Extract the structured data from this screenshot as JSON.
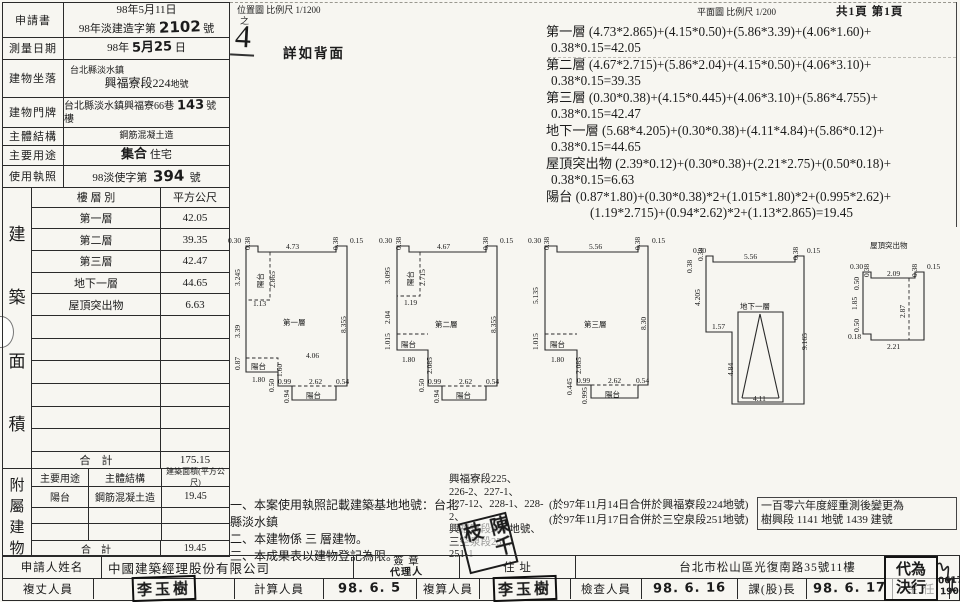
{
  "page": {
    "scale_note_left": "位置圖 比例尺 1/1200",
    "scale_note_left_sub": "之",
    "hand_page_no": "4",
    "detail_note": "詳如背面",
    "scale_note_right": "平面圖 比例尺  1/200",
    "page_count": "共1頁 第1頁"
  },
  "form": {
    "application_label": "申請書",
    "application_line1": "98年5月11日",
    "application_line2_pre": "98年淡建造字第",
    "application_line2_hand": "2102",
    "application_line2_suf": "號",
    "survey_label": "測量日期",
    "survey_pre": "98年",
    "survey_hand": "5月25",
    "survey_suf": "日",
    "location_label": "建物坐落",
    "location_line1": "台北縣淡水鎮",
    "location_line2": "興福寮段224",
    "location_line2_suf": "地號",
    "address_label": "建物門牌",
    "address_pre": "台北縣淡水鎮興福寮66巷",
    "address_hand": "143",
    "address_suf": "號　樓",
    "structure_label": "主體結構",
    "structure_value": "鋼筋混凝土造",
    "use_label": "主要用途",
    "use_hand": "集合",
    "use_value": "住宅",
    "license_label": "使用執照",
    "license_pre": "98淡使字第",
    "license_hand": "394",
    "license_suf": "號"
  },
  "area_table": {
    "section_chars": [
      "建",
      "築",
      "面",
      "積"
    ],
    "col_floor": "樓 層 別",
    "col_area": "平方公尺",
    "rows": [
      [
        "第一層",
        "42.05"
      ],
      [
        "第二層",
        "39.35"
      ],
      [
        "第三層",
        "42.47"
      ],
      [
        "地下一層",
        "44.65"
      ],
      [
        "屋頂突出物",
        "6.63"
      ]
    ],
    "total_label": "合　計",
    "total": "175.15"
  },
  "annex_table": {
    "section_chars": [
      "附",
      "屬",
      "建",
      "物"
    ],
    "col_use": "主要用途",
    "col_structure": "主體結構",
    "col_area": "建築面積(平方公尺)",
    "rows": [
      [
        "陽台",
        "鋼筋混凝土造",
        "19.45"
      ]
    ],
    "total_label": "合　計",
    "total": "19.45"
  },
  "formulas": [
    {
      "line1": "第一層 (4.73*2.865)+(4.15*0.50)+(5.86*3.39)+(4.06*1.60)+",
      "line2": "0.38*0.15=42.05"
    },
    {
      "line1": "第二層 (4.67*2.715)+(5.86*2.04)+(4.15*0.50)+(4.06*3.10)+",
      "line2": "0.38*0.15=39.35"
    },
    {
      "line1": "第三層 (0.30*0.38)+(4.15*0.445)+(4.06*3.10)+(5.86*4.755)+",
      "line2": "0.38*0.15=42.47"
    },
    {
      "line1": "地下一層 (5.68*4.205)+(0.30*0.38)+(4.11*4.84)+(5.86*0.12)+",
      "line2": "0.38*0.15=44.65"
    },
    {
      "line1": "屋頂突出物 (2.39*0.12)+(0.30*0.38)+(2.21*2.75)+(0.50*0.18)+",
      "line2": "0.38*0.15=6.63"
    },
    {
      "line1": "陽台 (0.87*1.80)+(0.30*0.38)*2+(1.015*1.80)*2+(0.995*2.62)+",
      "line2": "(1.19*2.715)+(0.94*2.62)*2+(1.13*2.865)=19.45"
    }
  ],
  "plans": [
    {
      "name": "第一層",
      "labels": [
        {
          "t": "0.30",
          "x": 2,
          "y": 17
        },
        {
          "t": "0.38",
          "x": 24,
          "y": 24,
          "r": 1
        },
        {
          "t": "4.73",
          "x": 60,
          "y": 23
        },
        {
          "t": "0.38",
          "x": 112,
          "y": 24,
          "r": 1
        },
        {
          "t": "0.15",
          "x": 124,
          "y": 17
        },
        {
          "t": "3.245",
          "x": 14,
          "y": 60,
          "r": 1
        },
        {
          "t": "陽台",
          "x": 37,
          "y": 62,
          "r": 1,
          "s": 9
        },
        {
          "t": "2.865",
          "x": 49,
          "y": 62,
          "r": 1
        },
        {
          "t": "1.13",
          "x": 27,
          "y": 80
        },
        {
          "t": "3.39",
          "x": 14,
          "y": 112,
          "r": 1
        },
        {
          "t": "第一層",
          "x": 57,
          "y": 99,
          "s": 11
        },
        {
          "t": "8.355",
          "x": 120,
          "y": 107,
          "r": 1
        },
        {
          "t": "4.06",
          "x": 80,
          "y": 132,
          "s": 10
        },
        {
          "t": "0.87",
          "x": 14,
          "y": 144,
          "r": 1
        },
        {
          "t": "陽台",
          "x": 25,
          "y": 143,
          "s": 9
        },
        {
          "t": "1.80",
          "x": 26,
          "y": 156
        },
        {
          "t": "1.60",
          "x": 56,
          "y": 151,
          "r": 1
        },
        {
          "t": "0.50",
          "x": 48,
          "y": 166,
          "r": 1
        },
        {
          "t": "0.99",
          "x": 52,
          "y": 158
        },
        {
          "t": "2.62",
          "x": 83,
          "y": 158
        },
        {
          "t": "0.54",
          "x": 110,
          "y": 158
        },
        {
          "t": "0.94",
          "x": 63,
          "y": 177,
          "r": 1
        },
        {
          "t": "陽台",
          "x": 80,
          "y": 172,
          "s": 9
        }
      ]
    },
    {
      "name": "第二層",
      "labels": [
        {
          "t": "0.30",
          "x": 2,
          "y": 17
        },
        {
          "t": "0.38",
          "x": 24,
          "y": 24,
          "r": 1
        },
        {
          "t": "4.67",
          "x": 60,
          "y": 23
        },
        {
          "t": "0.38",
          "x": 111,
          "y": 24,
          "r": 1
        },
        {
          "t": "0.15",
          "x": 123,
          "y": 17
        },
        {
          "t": "3.095",
          "x": 13,
          "y": 58,
          "r": 1
        },
        {
          "t": "陽台",
          "x": 36,
          "y": 60,
          "r": 1,
          "s": 9
        },
        {
          "t": "2.715",
          "x": 48,
          "y": 60,
          "r": 1
        },
        {
          "t": "1.19",
          "x": 27,
          "y": 79
        },
        {
          "t": "2.04",
          "x": 13,
          "y": 98,
          "r": 1
        },
        {
          "t": "第二層",
          "x": 58,
          "y": 101,
          "s": 11
        },
        {
          "t": "8.355",
          "x": 119,
          "y": 107,
          "r": 1
        },
        {
          "t": "1.015",
          "x": 13,
          "y": 124,
          "r": 1
        },
        {
          "t": "陽台",
          "x": 24,
          "y": 121,
          "s": 9
        },
        {
          "t": "1.80",
          "x": 25,
          "y": 136
        },
        {
          "t": "2.085",
          "x": 55,
          "y": 148,
          "r": 1
        },
        {
          "t": "0.50",
          "x": 47,
          "y": 166,
          "r": 1
        },
        {
          "t": "0.99",
          "x": 51,
          "y": 158
        },
        {
          "t": "2.62",
          "x": 82,
          "y": 158
        },
        {
          "t": "0.54",
          "x": 109,
          "y": 158
        },
        {
          "t": "0.94",
          "x": 62,
          "y": 177,
          "r": 1
        },
        {
          "t": "陽台",
          "x": 79,
          "y": 172,
          "s": 9
        }
      ]
    },
    {
      "name": "第三層",
      "labels": [
        {
          "t": "0.30",
          "x": 1,
          "y": 17
        },
        {
          "t": "0.38",
          "x": 22,
          "y": 24,
          "r": 1
        },
        {
          "t": "5.56",
          "x": 62,
          "y": 23
        },
        {
          "t": "0.38",
          "x": 113,
          "y": 24,
          "r": 1
        },
        {
          "t": "0.15",
          "x": 125,
          "y": 17
        },
        {
          "t": "5.135",
          "x": 11,
          "y": 78,
          "r": 1
        },
        {
          "t": "第三層",
          "x": 57,
          "y": 101,
          "s": 11
        },
        {
          "t": "8.30",
          "x": 119,
          "y": 104,
          "r": 1
        },
        {
          "t": "1.015",
          "x": 11,
          "y": 124,
          "r": 1
        },
        {
          "t": "陽台",
          "x": 23,
          "y": 121,
          "s": 9
        },
        {
          "t": "1.80",
          "x": 24,
          "y": 136
        },
        {
          "t": "2.085",
          "x": 54,
          "y": 148,
          "r": 1
        },
        {
          "t": "0.445",
          "x": 45,
          "y": 169,
          "r": 1
        },
        {
          "t": "0.99",
          "x": 50,
          "y": 157
        },
        {
          "t": "2.62",
          "x": 81,
          "y": 157
        },
        {
          "t": "0.54",
          "x": 109,
          "y": 157
        },
        {
          "t": "0.995",
          "x": 60,
          "y": 178,
          "r": 1
        },
        {
          "t": "陽台",
          "x": 78,
          "y": 171,
          "s": 9
        }
      ]
    },
    {
      "name": "地下一層",
      "labels": [
        {
          "t": "0.30",
          "x": 17,
          "y": 27,
          "s": 6
        },
        {
          "t": "0.38",
          "x": 27,
          "y": 35,
          "r": 1,
          "s": 6
        },
        {
          "t": "0.38",
          "x": 16,
          "y": 47,
          "r": 1,
          "s": 6
        },
        {
          "t": "5.56",
          "x": 68,
          "y": 33
        },
        {
          "t": "0.38",
          "x": 122,
          "y": 34,
          "r": 1
        },
        {
          "t": "0.15",
          "x": 131,
          "y": 27
        },
        {
          "t": "4.205",
          "x": 24,
          "y": 80,
          "r": 1
        },
        {
          "t": "地下一層",
          "x": 64,
          "y": 83,
          "s": 11
        },
        {
          "t": "1.57",
          "x": 36,
          "y": 103
        },
        {
          "t": "9.165",
          "x": 131,
          "y": 124,
          "r": 1
        },
        {
          "t": "4.84",
          "x": 57,
          "y": 150,
          "r": 1
        },
        {
          "t": "4.11",
          "x": 77,
          "y": 175
        }
      ]
    },
    {
      "name": "屋頂突出物",
      "labels": [
        {
          "t": "屋頂突出物",
          "x": 25,
          "y": 12,
          "s": 11
        },
        {
          "t": "0.30",
          "x": 5,
          "y": 33
        },
        {
          "t": "0.38",
          "x": 24,
          "y": 41,
          "r": 1
        },
        {
          "t": "2.09",
          "x": 42,
          "y": 40
        },
        {
          "t": "0.38",
          "x": 72,
          "y": 41,
          "r": 1
        },
        {
          "t": "0.15",
          "x": 82,
          "y": 33
        },
        {
          "t": "0.50",
          "x": 14,
          "y": 54,
          "r": 1
        },
        {
          "t": "1.85",
          "x": 12,
          "y": 74,
          "r": 1
        },
        {
          "t": "0.50",
          "x": 14,
          "y": 96,
          "r": 1
        },
        {
          "t": "0.18",
          "x": 3,
          "y": 103
        },
        {
          "t": "2.87",
          "x": 60,
          "y": 82,
          "r": 1
        },
        {
          "t": "2.21",
          "x": 42,
          "y": 113
        }
      ]
    }
  ],
  "notes": [
    "一、本案使用執照記載建築基地地號：台北縣淡水鎮",
    "二、本建物係 三 層建物。",
    "三、本成果表以建物登記為限。"
  ],
  "lot_lines": [
    "興福寮段225、",
    "226-2、227-1、",
    "227-12、228-1、228-2、",
    "興福寮段224 地號、",
    "三空泉段251、",
    "251-1"
  ],
  "merge_notes": [
    "(於97年11月14日合併於興福寮段224地號)",
    "(於97年11月17日合併於三空泉段251地號)"
  ],
  "resurvey_box": {
    "line1": "一百零六年度經重測後變更為",
    "line2": "樹興段 1141 地號 1439 建號"
  },
  "reviewer_stamp": "陳千枝",
  "footer": {
    "applicant_label": "申請人姓名",
    "applicant": "中國建築經理股份有限公司",
    "sign_label": "簽 章",
    "sign_hand": "代理人",
    "addr_label": "住 址",
    "addr": "台北市松山區光復南路35號11樓",
    "delegate_line1": "代為",
    "delegate_line2": "決行",
    "survey_label": "複丈人員",
    "survey_stamp": "李玉樹",
    "calc_label": "計算人員",
    "calc_date": "98. 6. 5",
    "recheck_label": "複算人員",
    "recheck_stamp": "李玉樹",
    "check_label": "檢查人員",
    "check_date": "98. 6. 16",
    "chief_label": "課(股)長",
    "chief_date": "98. 6. 17",
    "director_label": "主 任",
    "sig_no1": "0617",
    "sig_no2": "1900"
  }
}
